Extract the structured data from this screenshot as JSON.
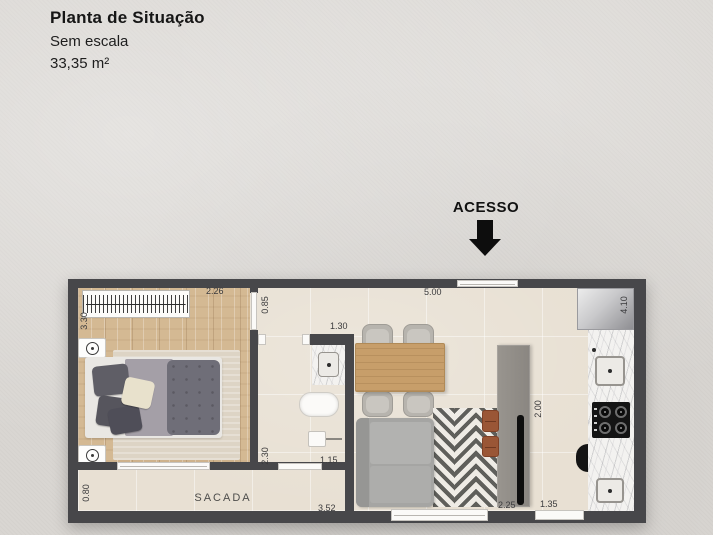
{
  "header": {
    "title": "Planta de Situação",
    "subtitle": "Sem escala",
    "area": "33,35 m²"
  },
  "access": {
    "label": "ACESSO"
  },
  "rooms": {
    "balcony_label": "SACADA"
  },
  "dims": {
    "bedroom_top": "2.26",
    "bedroom_left": "3.30",
    "hall": "0.85",
    "bath_door": "1.30",
    "living_top": "5.00",
    "kitchen_side": "4.10",
    "bath_side": "2.30",
    "bath_bottom": "1.15",
    "balcony_side": "0.80",
    "balcony_bottom": "3.52",
    "living_bottom": "2.25",
    "kitchen_bottom": "1.35",
    "counter_side": "2.00"
  },
  "colors": {
    "wall": "#47474a",
    "floor_tile": "#e8e0d3",
    "floor_wood": "#d4b993",
    "arrow": "#0d0d0d",
    "background": "#d9d6d2"
  }
}
